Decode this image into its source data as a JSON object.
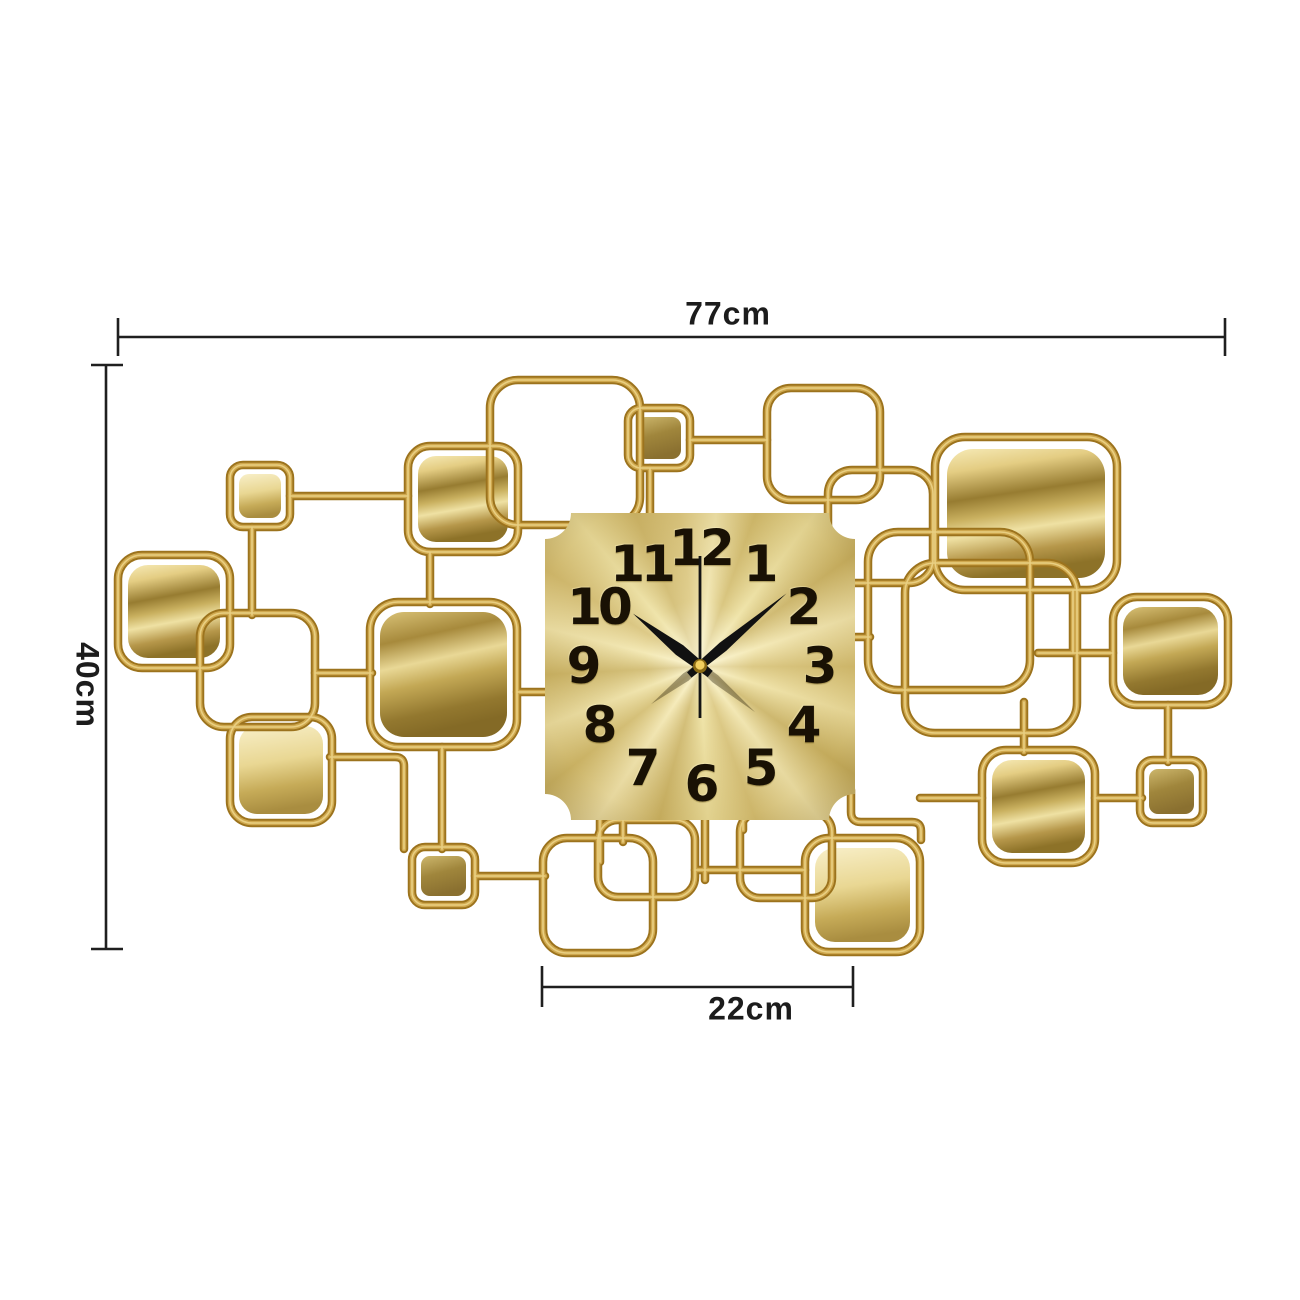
{
  "dimension_annotations": {
    "width": {
      "label": "77cm"
    },
    "height": {
      "label": "40cm"
    },
    "clock_width": {
      "label": "22cm"
    }
  },
  "clock": {
    "numerals": [
      "12",
      "1",
      "2",
      "3",
      "4",
      "5",
      "6",
      "7",
      "8",
      "9",
      "10",
      "11"
    ],
    "time_shown": "10:10:00",
    "hands": {
      "hour_angle_deg": -52,
      "minute_angle_deg": 50,
      "second_angle_deg": 0
    }
  },
  "colors": {
    "background": "#ffffff",
    "wire_gold_dark": "#9c731d",
    "wire_gold_mid": "#cfa84e",
    "wire_gold_highlight": "#ecd488",
    "dial_gold": "#e6d392",
    "numeral_color": "#191104",
    "hand_color": "#111111",
    "dimension_line_color": "#1f1f1f"
  }
}
